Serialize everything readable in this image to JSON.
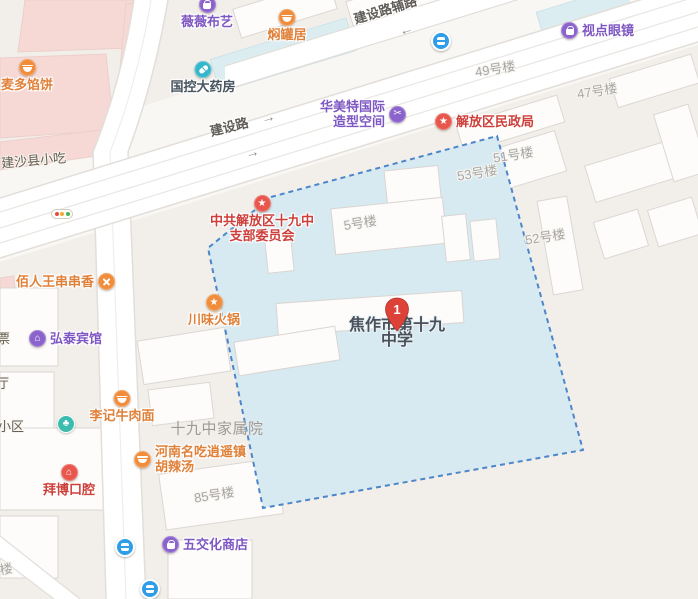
{
  "map": {
    "school": {
      "marker_number": "1",
      "name_line1": "焦作市第十九",
      "name_line2": "中学"
    },
    "roads": {
      "aux_road": "建设路辅路",
      "main_road": "建设路",
      "main_arrow": "→",
      "main_arrow2": "→",
      "aux_arrow": "←"
    },
    "pois": [
      {
        "name": "薇薇布艺",
        "icon": "shopping-bag",
        "color": "purple"
      },
      {
        "name": "焖罐居",
        "icon": "food-bowl",
        "color": "orange"
      },
      {
        "name": "麦多馅饼",
        "icon": "food-bowl",
        "color": "orange"
      },
      {
        "name": "国控大药房",
        "icon": "pharmacy-capsule",
        "color": "teal"
      },
      {
        "name": "视点眼镜",
        "icon": "shopping-bag",
        "color": "purple"
      },
      {
        "name": "华美特国际",
        "name2": "造型空间",
        "icon": "scissors",
        "color": "purple"
      },
      {
        "name": "解放区民政局",
        "icon": "government-star",
        "color": "red"
      },
      {
        "name": "中共解放区十九中",
        "name2": "支部委员会",
        "icon": "government-star",
        "color": "red"
      },
      {
        "name": "佰人王串串香",
        "icon": "cutlery-x",
        "color": "orange"
      },
      {
        "name": "川味火锅",
        "icon": "star",
        "color": "orange"
      },
      {
        "name": "弘泰宾馆",
        "icon": "hotel-house",
        "color": "purple"
      },
      {
        "name": "李记牛肉面",
        "icon": "food-bowl",
        "color": "orange"
      },
      {
        "name": "河南名吃逍遥镇",
        "name2": "胡辣汤",
        "icon": "food-bowl",
        "color": "orange"
      },
      {
        "name": "拜博口腔",
        "icon": "clinic-house",
        "color": "red"
      },
      {
        "name": "五交化商店",
        "icon": "shopping-bag",
        "color": "purple"
      }
    ],
    "building_labels": [
      {
        "text": "49号楼"
      },
      {
        "text": "47号楼"
      },
      {
        "text": "51号楼"
      },
      {
        "text": "53号楼"
      },
      {
        "text": "5号楼"
      },
      {
        "text": "52号楼"
      },
      {
        "text": "85号楼"
      },
      {
        "text": "楼"
      }
    ],
    "area_labels": [
      {
        "text": "建沙县小吃"
      },
      {
        "text": "十九中家属院"
      },
      {
        "text": "小区"
      },
      {
        "text": "票"
      },
      {
        "text": "厅"
      }
    ],
    "icons_legend": [
      "bus-stop-icon",
      "park-tree-icon",
      "traffic-light-icon",
      "location-pin-icon"
    ],
    "colors": {
      "zone_fill": "#d8eaf1",
      "zone_border": "#4d86c8",
      "poi_purple": "#8a63cc",
      "poi_orange": "#f08c3a",
      "poi_red": "#e8564c",
      "poi_teal": "#33b7cb",
      "bus_blue": "#2f9de8",
      "park_teal": "#3abcae",
      "marker_red": "#dd4238",
      "building_pink": "#f6d8d5",
      "building_cyan": "#dcedf1"
    }
  }
}
